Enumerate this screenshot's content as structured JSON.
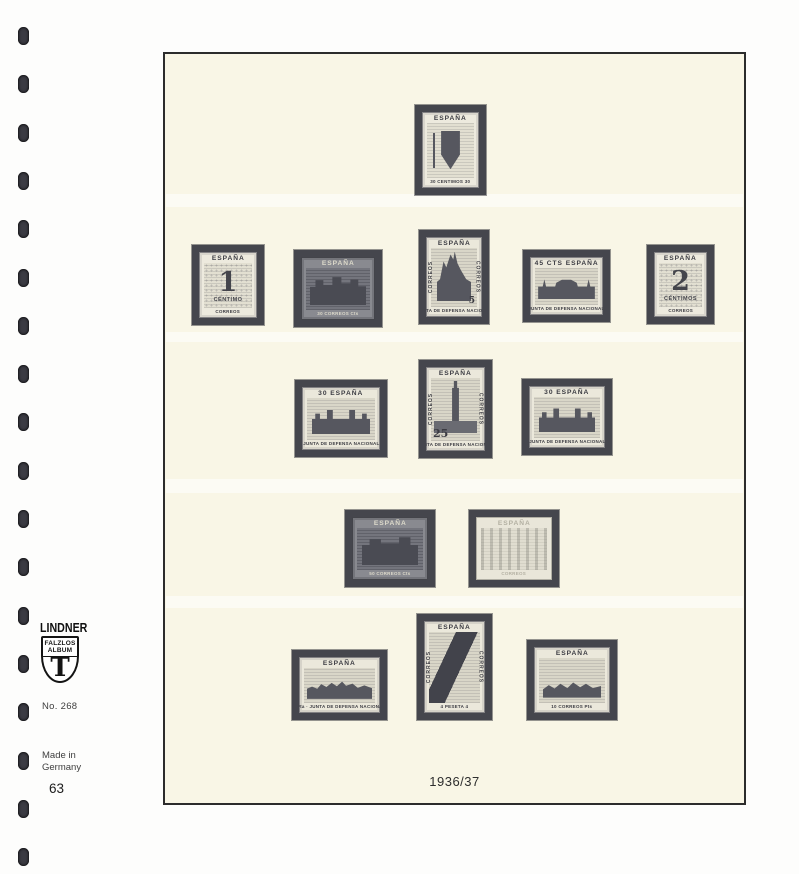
{
  "branding": {
    "logo": "LINDNER",
    "shield_line1": "FALZLOS",
    "shield_line2": "ALBUM",
    "shield_letter": "T",
    "number": "No. 268",
    "origin_line1": "Made in",
    "origin_line2": "Germany",
    "page_number": "63"
  },
  "page_label": {
    "year": "1936/37"
  },
  "colors": {
    "page_background": "#f9f6e6",
    "stamp_mount": "#45464d",
    "stamp_paper": "#ebe8db",
    "punch_hole": "#3b3b43"
  },
  "stamps": [
    {
      "name": "escudo-30cts",
      "left": 250,
      "top": 51,
      "width": 71,
      "height": 90,
      "tone": "light",
      "motif": "arms",
      "top_label": "ESPAÑA",
      "bottom_label": "30 CENTIMOS 30"
    },
    {
      "name": "cifra-1-centimo",
      "left": 27,
      "top": 191,
      "width": 72,
      "height": 80,
      "tone": "light",
      "motif": "numeral",
      "top_label": "ESPAÑA",
      "value": "1",
      "value_caption": "CÉNTIMO",
      "value_pos": "center",
      "bottom_label": "CORREOS"
    },
    {
      "name": "junta-30-correos",
      "left": 129,
      "top": 196,
      "width": 88,
      "height": 77,
      "tone": "dark",
      "motif": "buildings",
      "top_label": "ESPAÑA",
      "bottom_label": "30 CORREOS Cts"
    },
    {
      "name": "catedral-5-cts",
      "left": 254,
      "top": 176,
      "width": 70,
      "height": 94,
      "tone": "medium",
      "motif": "cathedral",
      "top_label": "ESPAÑA",
      "side_left": "CORREOS",
      "side_right": "CORREOS",
      "value": "5",
      "value_pos": "br",
      "bottom_label": "JUNTA DE DEFENSA NACIONAL"
    },
    {
      "name": "pilar-45-cts",
      "left": 358,
      "top": 196,
      "width": 87,
      "height": 72,
      "tone": "medium",
      "motif": "basilica",
      "top_label": "45 CTS ESPAÑA",
      "bottom_label": "JUNTA DE DEFENSA NACIONAL"
    },
    {
      "name": "cifra-2-centimos",
      "left": 482,
      "top": 191,
      "width": 67,
      "height": 79,
      "tone": "light",
      "motif": "numeral",
      "top_label": "ESPAÑA",
      "value": "2",
      "value_caption": "CÉNTIMOS",
      "value_pos": "center",
      "bottom_label": "CORREOS"
    },
    {
      "name": "castillo-30-cts-a",
      "left": 130,
      "top": 326,
      "width": 92,
      "height": 77,
      "tone": "medium",
      "motif": "castle",
      "top_label": "30 ESPAÑA",
      "bottom_label": "JUNTA DE DEFENSA NACIONAL"
    },
    {
      "name": "giralda-25-cts",
      "left": 254,
      "top": 306,
      "width": 73,
      "height": 98,
      "tone": "medium",
      "motif": "tower",
      "top_label": "ESPAÑA",
      "side_left": "CORREOS",
      "side_right": "CORREOS",
      "value": "25",
      "value_pos": "bl",
      "bottom_label": "JUNTA DE DEFENSA NACIONAL"
    },
    {
      "name": "castillo-30-cts-b",
      "left": 357,
      "top": 325,
      "width": 90,
      "height": 76,
      "tone": "medium",
      "motif": "castle",
      "top_label": "30 ESPAÑA",
      "bottom_label": "JUNTA DE DEFENSA NACIONAL"
    },
    {
      "name": "palacio-50-cts",
      "left": 180,
      "top": 456,
      "width": 90,
      "height": 77,
      "tone": "dark",
      "motif": "palace",
      "top_label": "ESPAÑA",
      "bottom_label": "50 CORREOS Cts"
    },
    {
      "name": "arcos-1-pta-faded",
      "left": 304,
      "top": 456,
      "width": 90,
      "height": 77,
      "tone": "faded",
      "motif": "arches",
      "top_label": "ESPAÑA",
      "bottom_label": "CORREOS"
    },
    {
      "name": "vista-1-pta",
      "left": 127,
      "top": 596,
      "width": 95,
      "height": 70,
      "tone": "medium",
      "motif": "cityscape",
      "top_label": "ESPAÑA",
      "bottom_label": "1Pta · JUNTA DE DEFENSA NACIONAL"
    },
    {
      "name": "bandera-4-pesetas",
      "left": 252,
      "top": 560,
      "width": 75,
      "height": 106,
      "tone": "medium",
      "motif": "flag",
      "top_label": "ESPAÑA",
      "side_left": "CORREOS",
      "side_right": "CORREOS",
      "bottom_label": "4 PESETA 4"
    },
    {
      "name": "caballeria-10-pts",
      "left": 362,
      "top": 586,
      "width": 90,
      "height": 80,
      "tone": "medium",
      "motif": "cavalry",
      "top_label": "ESPAÑA",
      "bottom_label": "10 CORREOS Pts"
    }
  ]
}
